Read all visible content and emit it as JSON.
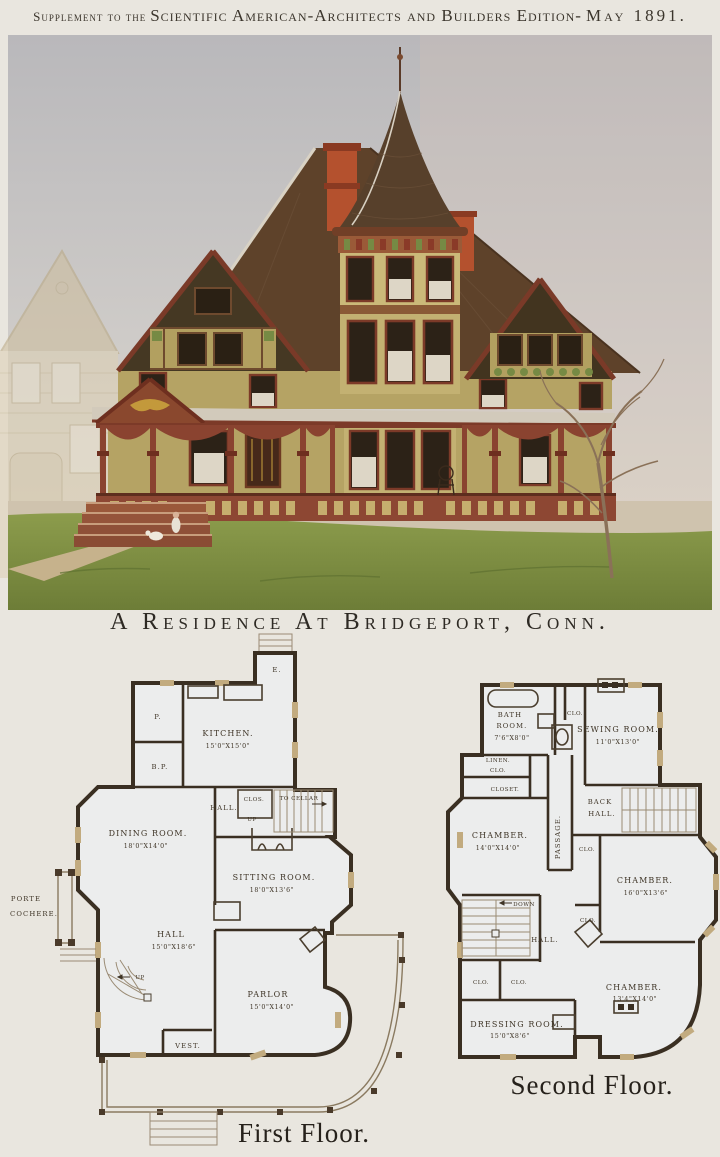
{
  "plate": {
    "header": {
      "prefix": "Supplement to the",
      "main": "Scientific American-Architects and Builders Edition-",
      "date": "May 1891."
    },
    "title": "A Residence At Bridgeport, Conn.",
    "illustration": {
      "subject": "victorian-residence-color-painting",
      "colors": {
        "sky": "#c6c4c5",
        "roof": "#5e422a",
        "wall_shingle": "#b5a364",
        "trim": "#8a4330",
        "chimney": "#b4512e",
        "grass": "#7d9143",
        "neighbor_sepia": "#d8cbae"
      }
    },
    "first_floor": {
      "caption": "First Floor.",
      "entry": "E.",
      "pantry": "P.",
      "butlers_pantry": "B.P.",
      "kitchen": {
        "name": "KITCHEN.",
        "dims": "15'0\"X15'0\""
      },
      "rear_hall": "HALL.",
      "closet": "CLOS.",
      "to_cellar": "TO CELLAR",
      "up_rear": "UP",
      "dining_room": {
        "name": "DINING ROOM.",
        "dims": "18'0\"X14'0\""
      },
      "sitting_room": {
        "name": "SITTING ROOM.",
        "dims": "18'0\"X13'6\""
      },
      "hall": {
        "name": "HALL",
        "dims": "15'0\"X18'6\""
      },
      "up_main": "UP",
      "parlor": {
        "name": "PARLOR",
        "dims": "15'0\"X14'0\""
      },
      "vestibule": "VEST.",
      "porte_cochere_line1": "PORTE",
      "porte_cochere_line2": "COCHERE."
    },
    "second_floor": {
      "caption": "Second Floor.",
      "bath_line1": "BATH",
      "bath_line2": "ROOM.",
      "bath_dims": "7'6\"X8'0\"",
      "closet_top": "CLO.",
      "sewing_room": {
        "name": "SEWING ROOM.",
        "dims": "11'0\"X13'0\""
      },
      "linen_line1": "LINEN.",
      "linen_line2": "CLO.",
      "closet_mid": "CLOSET.",
      "back_hall_line1": "BACK",
      "back_hall_line2": "HALL.",
      "passage": "PASSAGE.",
      "chamber_sw": {
        "name": "CHAMBER.",
        "dims": "14'0\"X14'0\""
      },
      "clo_a": "CLO.",
      "chamber_e": {
        "name": "CHAMBER.",
        "dims": "16'0\"X13'6\""
      },
      "down": "DOWN",
      "clo_b": "CLO.",
      "hall": "HALL.",
      "clo_c": "CLO.",
      "clo_d": "CLO.",
      "chamber_se": {
        "name": "CHAMBER.",
        "dims": "13'4\"X14'0\""
      },
      "dressing_room": {
        "name": "DRESSING ROOM.",
        "dims": "15'0\"X8'6\""
      }
    }
  }
}
